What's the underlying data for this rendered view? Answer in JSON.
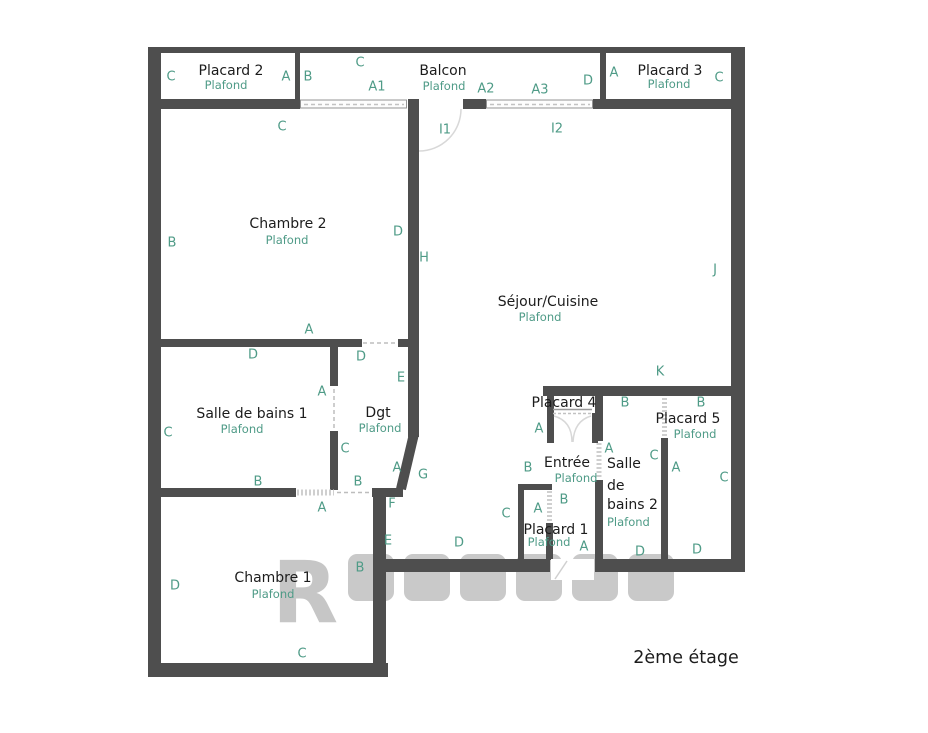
{
  "floor_label": "2ème étage",
  "watermark_letter": "R",
  "colors": {
    "wall": "#4e4e4e",
    "label_green": "#4f9b87",
    "text_dark": "#1c1c1c",
    "dash_gray": "#c2c2c2",
    "watermark_gray": "#c6c6c6"
  },
  "rooms": [
    {
      "id": "placard-2",
      "name": "Placard 2",
      "plafond": "Plafond",
      "nx": 231,
      "ny": 71,
      "px": 226,
      "py": 85
    },
    {
      "id": "balcon",
      "name": "Balcon",
      "plafond": "Plafond",
      "nx": 443,
      "ny": 71,
      "px": 444,
      "py": 86
    },
    {
      "id": "placard-3",
      "name": "Placard 3",
      "plafond": "Plafond",
      "nx": 670,
      "ny": 71,
      "px": 669,
      "py": 84
    },
    {
      "id": "chambre-2",
      "name": "Chambre 2",
      "plafond": "Plafond",
      "nx": 288,
      "ny": 224,
      "px": 287,
      "py": 240
    },
    {
      "id": "sejour-cuisine",
      "name": "Séjour/Cuisine",
      "plafond": "Plafond",
      "nx": 548,
      "ny": 302,
      "px": 540,
      "py": 317
    },
    {
      "id": "salle-de-bains-1",
      "name": "Salle de bains 1",
      "plafond": "Plafond",
      "nx": 252,
      "ny": 414,
      "px": 242,
      "py": 429
    },
    {
      "id": "dgt",
      "name": "Dgt",
      "plafond": "Plafond",
      "nx": 378,
      "ny": 413,
      "px": 380,
      "py": 428
    },
    {
      "id": "placard-4",
      "name": "Placard 4",
      "plafond": null,
      "nx": 564,
      "ny": 403,
      "px": null,
      "py": null
    },
    {
      "id": "entree",
      "name": "Entrée",
      "plafond": "Plafond",
      "nx": 567,
      "ny": 463,
      "px": 576,
      "py": 478
    },
    {
      "id": "salle-de-bains-2",
      "name": "Salle de bains 2",
      "plafond": "Plafond",
      "lines": [
        "Salle",
        "de",
        "bains 2"
      ],
      "lx": 607,
      "lys": [
        464,
        486,
        505
      ],
      "px": 607,
      "py": 522
    },
    {
      "id": "placard-5",
      "name": "Placard 5",
      "plafond": "Plafond",
      "nx": 688,
      "ny": 419,
      "px": 695,
      "py": 434
    },
    {
      "id": "placard-1",
      "name": "Placard 1",
      "plafond": "Plafond",
      "nx": 556,
      "ny": 530,
      "px": 549,
      "py": 542
    },
    {
      "id": "chambre-1",
      "name": "Chambre 1",
      "plafond": "Plafond",
      "nx": 273,
      "ny": 578,
      "px": 273,
      "py": 594
    }
  ],
  "wall_letters": [
    {
      "t": "C",
      "x": 171,
      "y": 77
    },
    {
      "t": "A",
      "x": 286,
      "y": 77
    },
    {
      "t": "B",
      "x": 308,
      "y": 77
    },
    {
      "t": "C",
      "x": 360,
      "y": 63
    },
    {
      "t": "A1",
      "x": 377,
      "y": 87
    },
    {
      "t": "A2",
      "x": 486,
      "y": 89
    },
    {
      "t": "A3",
      "x": 540,
      "y": 90
    },
    {
      "t": "D",
      "x": 588,
      "y": 81
    },
    {
      "t": "A",
      "x": 614,
      "y": 73
    },
    {
      "t": "C",
      "x": 719,
      "y": 78
    },
    {
      "t": "C",
      "x": 282,
      "y": 127
    },
    {
      "t": "I1",
      "x": 445,
      "y": 130
    },
    {
      "t": "I2",
      "x": 557,
      "y": 129
    },
    {
      "t": "B",
      "x": 172,
      "y": 243
    },
    {
      "t": "D",
      "x": 398,
      "y": 232
    },
    {
      "t": "H",
      "x": 424,
      "y": 258
    },
    {
      "t": "J",
      "x": 715,
      "y": 270
    },
    {
      "t": "A",
      "x": 309,
      "y": 330
    },
    {
      "t": "D",
      "x": 253,
      "y": 355
    },
    {
      "t": "D",
      "x": 361,
      "y": 357
    },
    {
      "t": "E",
      "x": 401,
      "y": 378
    },
    {
      "t": "A",
      "x": 322,
      "y": 392
    },
    {
      "t": "C",
      "x": 168,
      "y": 433
    },
    {
      "t": "C",
      "x": 345,
      "y": 449
    },
    {
      "t": "A",
      "x": 397,
      "y": 468
    },
    {
      "t": "G",
      "x": 423,
      "y": 475
    },
    {
      "t": "B",
      "x": 258,
      "y": 482
    },
    {
      "t": "B",
      "x": 358,
      "y": 482
    },
    {
      "t": "K",
      "x": 660,
      "y": 372
    },
    {
      "t": "B",
      "x": 625,
      "y": 403
    },
    {
      "t": "B",
      "x": 701,
      "y": 403
    },
    {
      "t": "A",
      "x": 539,
      "y": 429
    },
    {
      "t": "B",
      "x": 528,
      "y": 468
    },
    {
      "t": "A",
      "x": 609,
      "y": 449
    },
    {
      "t": "C",
      "x": 654,
      "y": 456
    },
    {
      "t": "A",
      "x": 676,
      "y": 468
    },
    {
      "t": "C",
      "x": 724,
      "y": 478
    },
    {
      "t": "B",
      "x": 564,
      "y": 500
    },
    {
      "t": "C",
      "x": 506,
      "y": 514
    },
    {
      "t": "A",
      "x": 538,
      "y": 509
    },
    {
      "t": "A",
      "x": 584,
      "y": 547
    },
    {
      "t": "D",
      "x": 640,
      "y": 552
    },
    {
      "t": "D",
      "x": 697,
      "y": 550
    },
    {
      "t": "F",
      "x": 392,
      "y": 504
    },
    {
      "t": "E",
      "x": 388,
      "y": 541
    },
    {
      "t": "D",
      "x": 459,
      "y": 543
    },
    {
      "t": "A",
      "x": 322,
      "y": 508
    },
    {
      "t": "D",
      "x": 175,
      "y": 586
    },
    {
      "t": "B",
      "x": 360,
      "y": 568
    },
    {
      "t": "C",
      "x": 302,
      "y": 654
    }
  ]
}
